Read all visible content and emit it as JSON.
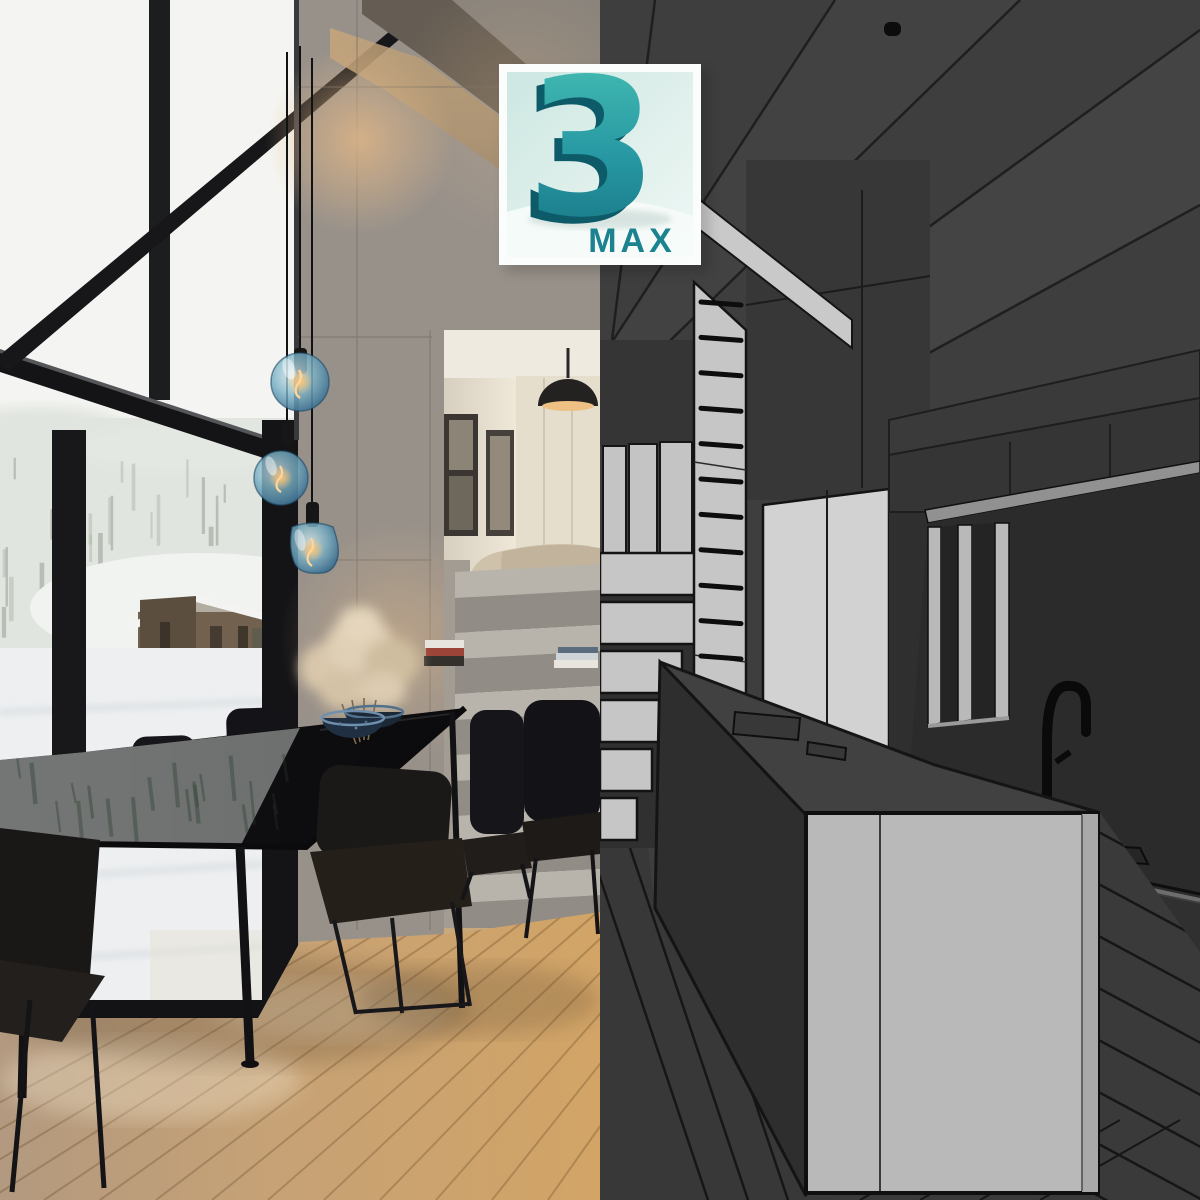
{
  "logo": {
    "digit": "3",
    "label": "MAX",
    "label_color": "#1b8290",
    "digit_front_top": "#49c2b5",
    "digit_front_bottom": "#16707f",
    "digit_extrude": "#0d5a68",
    "badge_border": "#fbfdfc",
    "badge_bg_top": "#cde7e2",
    "badge_bg_bottom": "#eef8f5"
  },
  "counts": {
    "pendant_lamps": 3,
    "dining_chairs": 7,
    "bowls_on_table": 2,
    "drawer_handles": 15,
    "wireframe_steps": 6,
    "photo_stair_steps": 6,
    "ceiling_spot_lights": 3
  },
  "palette": {
    "photo_sky": "#f4f5f2",
    "photo_forest": "#e1e5df",
    "photo_snow": "#edeff0",
    "photo_concrete": "#98918a",
    "photo_wood_floor": "#c6a276",
    "photo_window_frame": "#17171a",
    "photo_table": "#101013",
    "pendant_glass_blue": "#3f7ba0",
    "filament_warm": "#ffd49a",
    "wire_base_gray": "#3e3e3e",
    "wire_dark_gray": "#2b2b2b",
    "wire_light_panel": "#c6c6c6",
    "wire_island_panel": "#b9b9b9",
    "wire_outline": "#141414"
  }
}
